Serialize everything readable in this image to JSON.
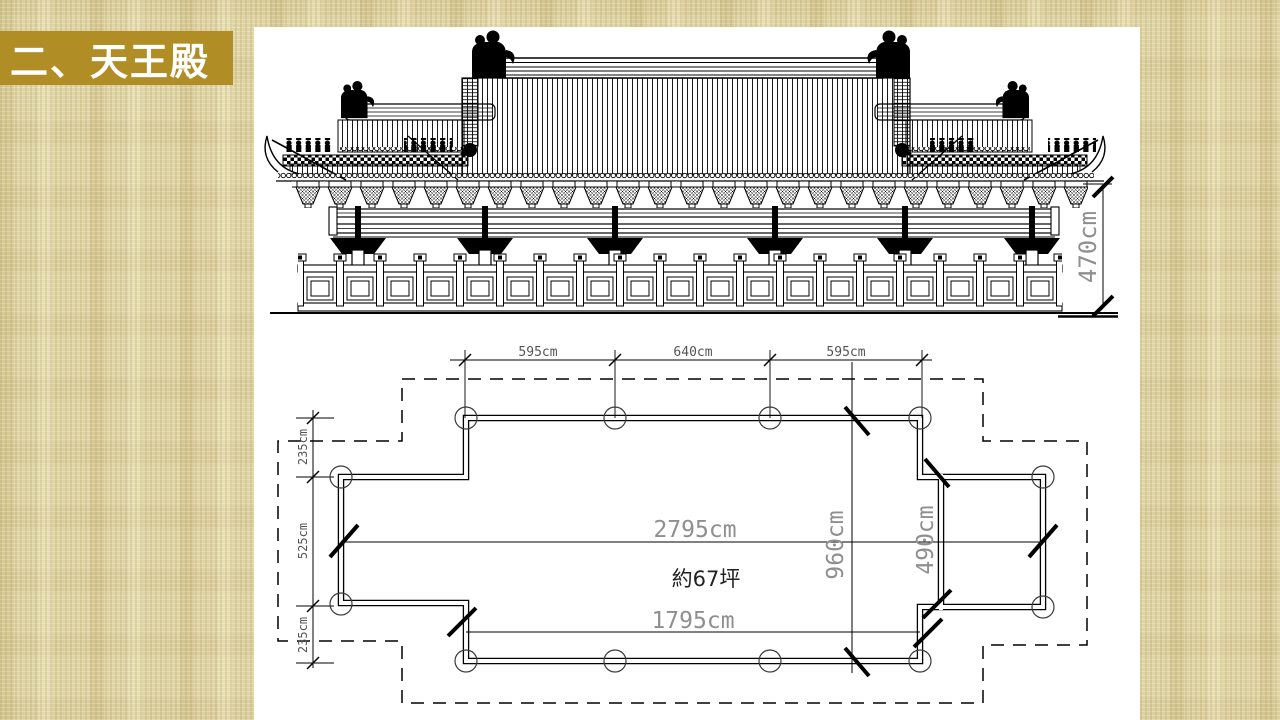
{
  "slide": {
    "title": "二、天王殿"
  },
  "colors": {
    "banner_gold": "#B18E25",
    "background_tan": "#E0D5A6",
    "panel_white": "#FFFFFF",
    "ink": "#000000",
    "dim_text_large": "#8F8F8F",
    "dim_text_small": "#555555"
  },
  "elevation": {
    "dims": {
      "height": "470cm"
    }
  },
  "plan": {
    "dims": {
      "top": [
        "595cm",
        "640cm",
        "595cm"
      ],
      "left": [
        "235cm",
        "525cm",
        "235cm"
      ],
      "overall_width": "2795cm",
      "inner_width": "1795cm",
      "main_depth": "960cm",
      "annex_depth": "490cm",
      "area": "約67坪"
    }
  }
}
